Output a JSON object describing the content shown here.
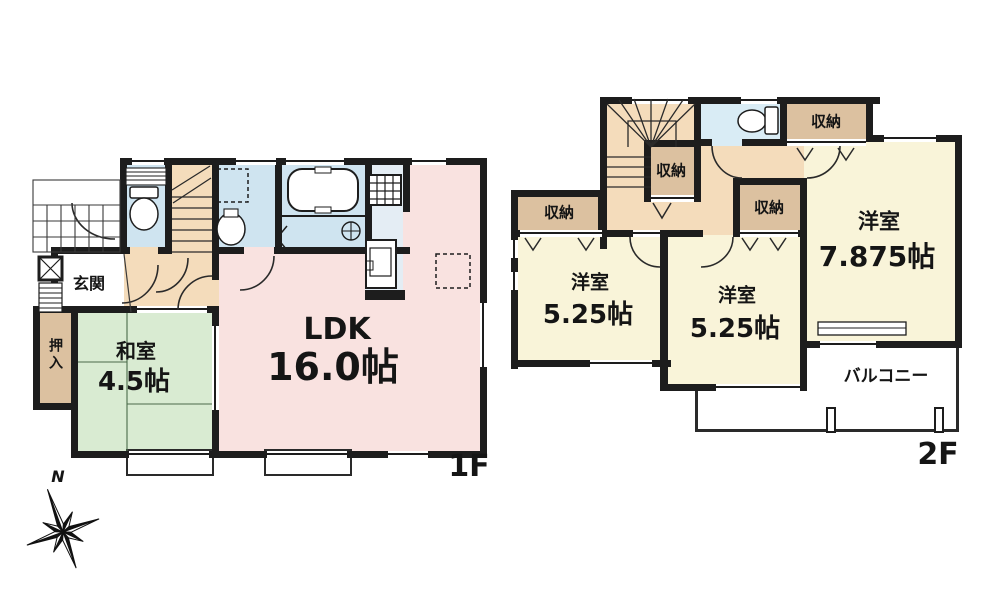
{
  "title": "2-story house floor plan",
  "floor1": {
    "floor_label": "1F",
    "entrance": "玄関",
    "closet": "押入",
    "washitsu": {
      "name": "和室",
      "size": "4.5帖"
    },
    "ldk": {
      "name": "LDK",
      "size": "16.0帖"
    }
  },
  "floor2": {
    "floor_label": "2F",
    "storage_label": "収納",
    "room_small_left": {
      "name": "洋室",
      "size": "5.25帖"
    },
    "room_small_mid": {
      "name": "洋室",
      "size": "5.25帖"
    },
    "room_large": {
      "name": "洋室",
      "size": "7.875帖"
    },
    "balcony": "バルコニー"
  },
  "compass": {
    "north_label": "N"
  },
  "colors": {
    "wall": "#1d1d1d",
    "ldk_floor": "#f9e2e0",
    "tatami_floor": "#d9ebd2",
    "wet_floor": "#cfe4f0",
    "kitchen_floor": "#e4edf4",
    "hall_floor": "#f4dcbb",
    "closet_floor": "#dcc1a0",
    "western_floor": "#f9f4d9",
    "toilet2_floor": "#d9ecf5"
  }
}
